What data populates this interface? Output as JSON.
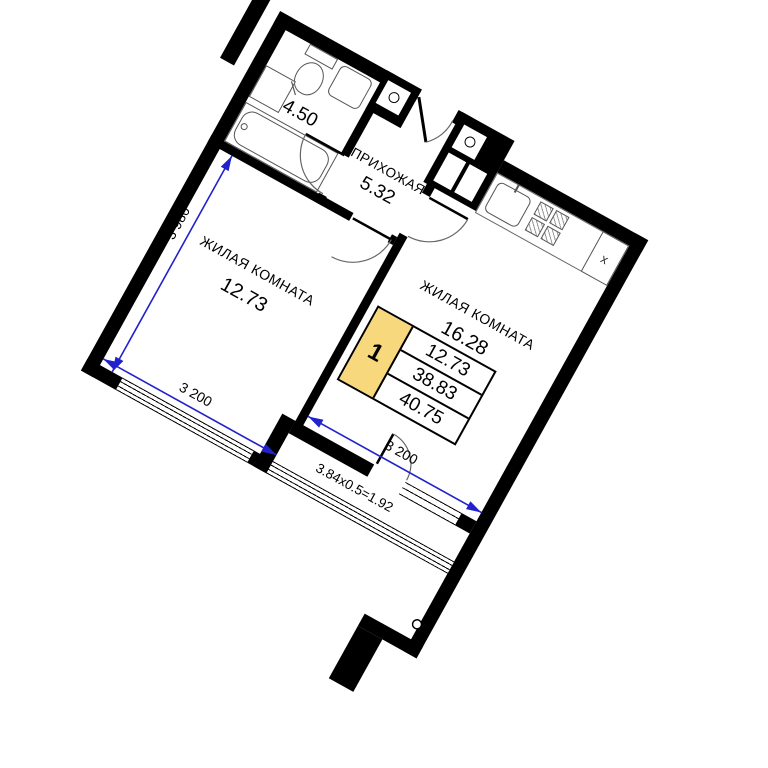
{
  "plan": {
    "bathroom": {
      "area": "4.50"
    },
    "hallway": {
      "name": "ПРИХОЖАЯ",
      "area": "5.32"
    },
    "room1": {
      "name": "ЖИЛАЯ КОМНАТА",
      "area": "12.73"
    },
    "room2": {
      "name": "ЖИЛАЯ КОМНАТА",
      "area": "16.28"
    },
    "balcony": {
      "label": "3.84x0.5=1.92"
    },
    "dimensions": {
      "room1_depth": "3 980",
      "room1_width": "3 200",
      "room2_width": "3 200"
    },
    "info_table": {
      "rooms_count": "1",
      "values": [
        "12.73",
        "38.83",
        "40.75"
      ]
    },
    "kitchen": {
      "fridge_mark": "x"
    },
    "colors": {
      "wall": "#000000",
      "dimension_line": "#2222cc",
      "table_highlight": "#f7d87c"
    }
  }
}
